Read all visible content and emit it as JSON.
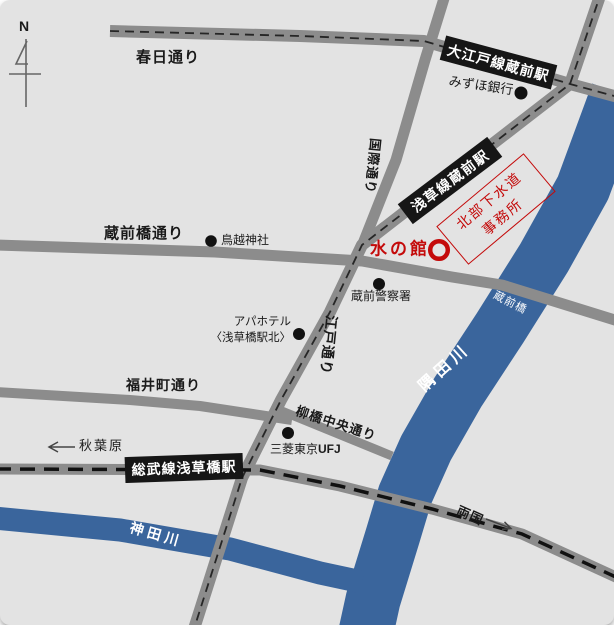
{
  "compass": {
    "north": "N"
  },
  "colors": {
    "background": "#e3e3e3",
    "road": "#8c8c8c",
    "river": "#3a659c",
    "station_box": "#161616",
    "accent_red": "#c40a0a",
    "text": "#1a1a1a",
    "river_label": "#ffffff"
  },
  "stations": {
    "oedo_kuramae": "大江戸線蔵前駅",
    "asakusa_kuramae": "浅草線蔵前駅",
    "sobu_asakusabashi": "総武線浅草橋駅"
  },
  "streets": {
    "kasuga": "春日通り",
    "kuramaebashi": "蔵前橋通り",
    "kokusai": "国際通り",
    "edo": "江戸通り",
    "fukuimachi": "福井町通り",
    "yanagibashi_chuo": "柳橋中央通り"
  },
  "rivers": {
    "sumida": "隅田川",
    "kanda": "神田川"
  },
  "bridges": {
    "kuramaebashi": "蔵前橋"
  },
  "landmarks": {
    "mizuho_bank": "みずほ銀行",
    "torigoe_shrine": "鳥越神社",
    "kuramae_police": "蔵前警察署",
    "apa_hotel_line1": "アパホテル",
    "apa_hotel_line2": "〈浅草橋駅北〉",
    "mitsubishi_kanji": "三菱東京",
    "mitsubishi_latin": "UFJ"
  },
  "destination": {
    "name": "水の館",
    "office_line1": "北部下水道",
    "office_line2": "事務所"
  },
  "directions": {
    "akihabara": "秋葉原",
    "ryogoku": "両国"
  }
}
